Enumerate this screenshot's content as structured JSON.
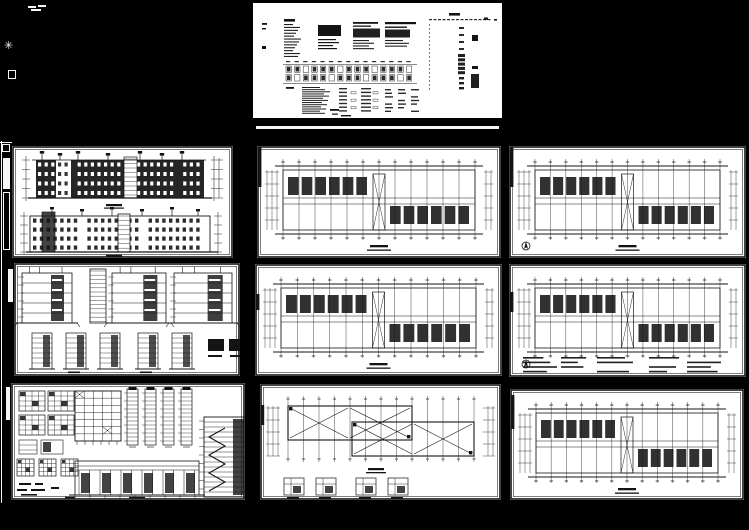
{
  "canvas": {
    "width": 749,
    "height": 530,
    "background": "#000000"
  },
  "palette": {
    "sheet": "#ffffff",
    "ink": "#141414",
    "accent": "#f5f5f5"
  },
  "sheets": [
    {
      "name": "title-block-and-drawing-index-sheet",
      "kind": "schedule",
      "x": 253,
      "y": 3,
      "w": 249,
      "h": 115
    },
    {
      "name": "building-elevations-sheet",
      "kind": "elevations",
      "x": 12,
      "y": 146,
      "w": 221,
      "h": 112
    },
    {
      "name": "floor-plan-sheet-1",
      "kind": "plan",
      "x": 257,
      "y": 146,
      "w": 244,
      "h": 112,
      "opt": {
        "nub": [
          1,
          40
        ],
        "label": true
      }
    },
    {
      "name": "floor-plan-sheet-2",
      "kind": "plan",
      "x": 509,
      "y": 146,
      "w": 237,
      "h": 112,
      "opt": {
        "nub": [
          1,
          40
        ],
        "label": true,
        "compass": true
      }
    },
    {
      "name": "building-sections-sheet",
      "kind": "sections",
      "x": 14,
      "y": 263,
      "w": 226,
      "h": 113
    },
    {
      "name": "floor-plan-sheet-3",
      "kind": "plan",
      "x": 255,
      "y": 264,
      "w": 247,
      "h": 112,
      "opt": {
        "nub": [
          30,
          16
        ],
        "label": true
      }
    },
    {
      "name": "floor-plan-sheet-4",
      "kind": "plan",
      "x": 509,
      "y": 264,
      "w": 237,
      "h": 113,
      "opt": {
        "nub": [
          28,
          20
        ],
        "notes": true,
        "compass": true
      }
    },
    {
      "name": "construction-details-sheet",
      "kind": "details",
      "x": 11,
      "y": 383,
      "w": 234,
      "h": 117
    },
    {
      "name": "roof-plan-sheet",
      "kind": "roofplan",
      "x": 260,
      "y": 384,
      "w": 241,
      "h": 116,
      "opt": {
        "nub": [
          21,
          20
        ]
      }
    },
    {
      "name": "floor-plan-sheet-5",
      "kind": "plan",
      "x": 510,
      "y": 389,
      "w": 234,
      "h": 111,
      "opt": {
        "nub": [
          6,
          34
        ],
        "label": true
      }
    }
  ],
  "accents": [
    {
      "name": "margin-tick",
      "style": "solid",
      "x": 28,
      "y": 6,
      "w": 8,
      "h": 2
    },
    {
      "name": "margin-tick",
      "style": "solid",
      "x": 38,
      "y": 5,
      "w": 8,
      "h": 2
    },
    {
      "name": "margin-tick",
      "style": "solid",
      "x": 31,
      "y": 9,
      "w": 10,
      "h": 2
    },
    {
      "name": "margin-star-mark",
      "style": "glyph",
      "x": 4,
      "y": 40,
      "size": 11,
      "char": "✳"
    },
    {
      "name": "margin-square-mark",
      "style": "outline",
      "x": 8,
      "y": 70,
      "w": 8,
      "h": 9
    },
    {
      "name": "margin-trim-line",
      "style": "solid",
      "x": 1,
      "y": 141,
      "w": 1,
      "h": 362
    },
    {
      "name": "margin-trim-line",
      "style": "solid",
      "x": 0,
      "y": 142,
      "w": 12,
      "h": 1
    },
    {
      "name": "margin-square-mark",
      "style": "outline",
      "x": 2,
      "y": 144,
      "w": 8,
      "h": 8
    },
    {
      "name": "margin-bar",
      "style": "solid",
      "x": 3,
      "y": 158,
      "w": 7,
      "h": 31
    },
    {
      "name": "margin-bar-outline",
      "style": "outline",
      "x": 3,
      "y": 192,
      "w": 7,
      "h": 58
    },
    {
      "name": "margin-bar",
      "style": "solid",
      "x": 8,
      "y": 269,
      "w": 5,
      "h": 33
    },
    {
      "name": "margin-bar",
      "style": "solid",
      "x": 6,
      "y": 387,
      "w": 4,
      "h": 33
    },
    {
      "name": "title-block-underline",
      "style": "solid",
      "x": 256,
      "y": 126,
      "w": 243,
      "h": 3
    }
  ]
}
